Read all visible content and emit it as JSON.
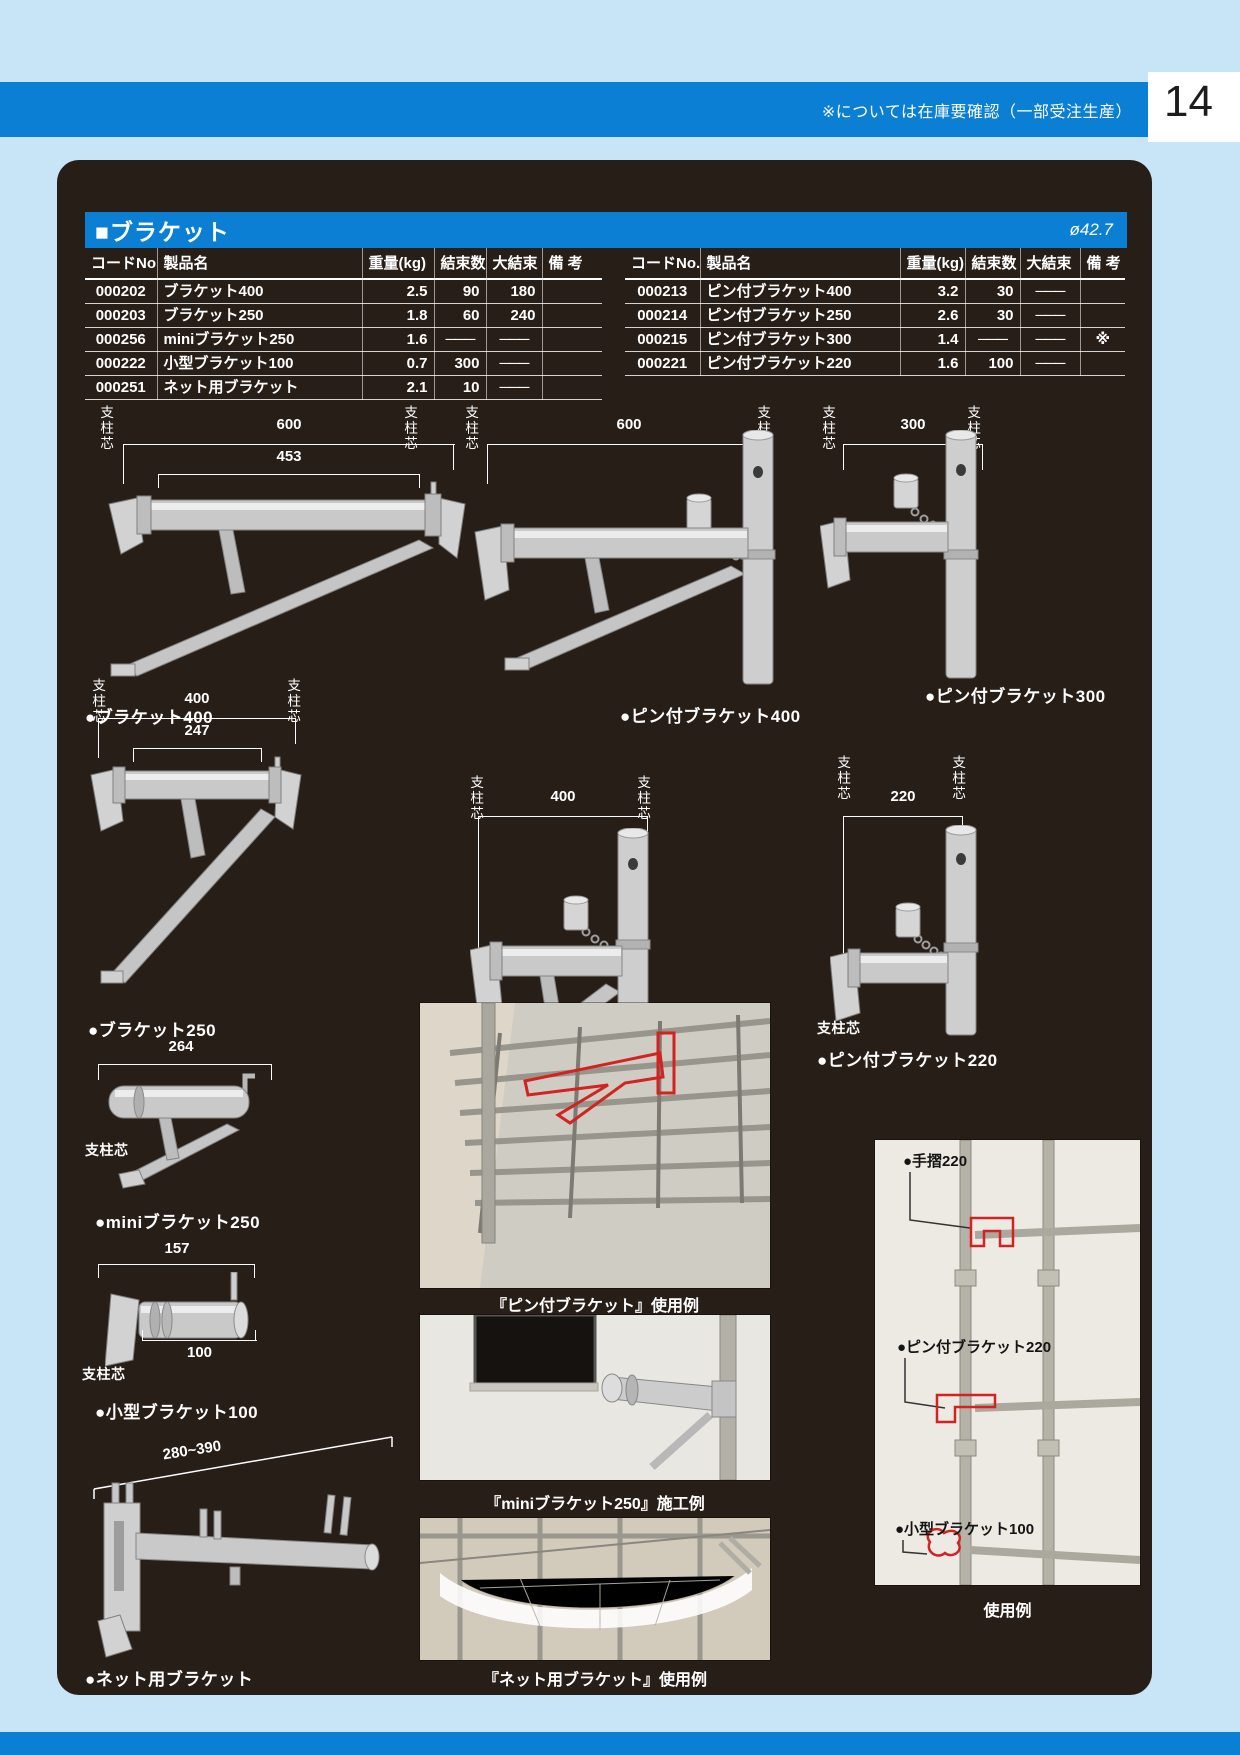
{
  "page": {
    "number": "14",
    "header_note": "※については在庫要確認（一部受注生産）"
  },
  "section": {
    "title": "■ブラケット",
    "diameter_note": "ø42.7"
  },
  "table": {
    "headers": [
      "コードNo.",
      "製品名",
      "重量(kg)",
      "結束数",
      "大結束",
      "備 考"
    ],
    "left_rows": [
      {
        "code": "000202",
        "name": "ブラケット400",
        "weight": "2.5",
        "bundle": "90",
        "large_bundle": "180",
        "note": ""
      },
      {
        "code": "000203",
        "name": "ブラケット250",
        "weight": "1.8",
        "bundle": "60",
        "large_bundle": "240",
        "note": ""
      },
      {
        "code": "000256",
        "name": "miniブラケット250",
        "weight": "1.6",
        "bundle": "───",
        "large_bundle": "───",
        "note": ""
      },
      {
        "code": "000222",
        "name": "小型ブラケット100",
        "weight": "0.7",
        "bundle": "300",
        "large_bundle": "───",
        "note": ""
      },
      {
        "code": "000251",
        "name": "ネット用ブラケット",
        "weight": "2.1",
        "bundle": "10",
        "large_bundle": "───",
        "note": ""
      }
    ],
    "right_rows": [
      {
        "code": "000213",
        "name": "ピン付ブラケット400",
        "weight": "3.2",
        "bundle": "30",
        "large_bundle": "───",
        "note": ""
      },
      {
        "code": "000214",
        "name": "ピン付ブラケット250",
        "weight": "2.6",
        "bundle": "30",
        "large_bundle": "───",
        "note": ""
      },
      {
        "code": "000215",
        "name": "ピン付ブラケット300",
        "weight": "1.4",
        "bundle": "───",
        "large_bundle": "───",
        "note": "※"
      },
      {
        "code": "000221",
        "name": "ピン付ブラケット220",
        "weight": "1.6",
        "bundle": "100",
        "large_bundle": "───",
        "note": ""
      }
    ]
  },
  "labels": {
    "pillar": "支柱芯"
  },
  "figures": {
    "bracket400": {
      "caption": "●ブラケット400",
      "dim_outer": "600",
      "dim_inner": "453"
    },
    "pin_bracket400": {
      "caption": "●ピン付ブラケット400",
      "dim": "600"
    },
    "pin_bracket300": {
      "caption": "●ピン付ブラケット300",
      "dim": "300"
    },
    "bracket250": {
      "caption": "●ブラケット250",
      "dim_outer": "400",
      "dim_inner": "247"
    },
    "pin_bracket250": {
      "caption": "●ピン付ブラケット250",
      "dim": "400"
    },
    "pin_bracket220": {
      "caption": "●ピン付ブラケット220",
      "dim": "220"
    },
    "mini_bracket250": {
      "caption": "●miniブラケット250",
      "dim": "264"
    },
    "small_bracket100": {
      "caption": "●小型ブラケット100",
      "dim_top": "157",
      "dim_bottom": "100"
    },
    "net_bracket": {
      "caption": "●ネット用ブラケット",
      "dim": "280~390"
    }
  },
  "photos": {
    "pin_usage": {
      "caption": "『ピン付ブラケット』使用例"
    },
    "mini_install": {
      "caption": "『miniブラケット250』施工例"
    },
    "net_usage": {
      "caption": "『ネット用ブラケット』使用例"
    },
    "usage_example": {
      "caption": "使用例",
      "labels": [
        "●手摺220",
        "●ピン付ブラケット220",
        "●小型ブラケット100"
      ]
    }
  },
  "colors": {
    "accent_blue": "#0a7fd3",
    "page_bg": "#c8e5f8",
    "panel_bg": "#281e18"
  }
}
